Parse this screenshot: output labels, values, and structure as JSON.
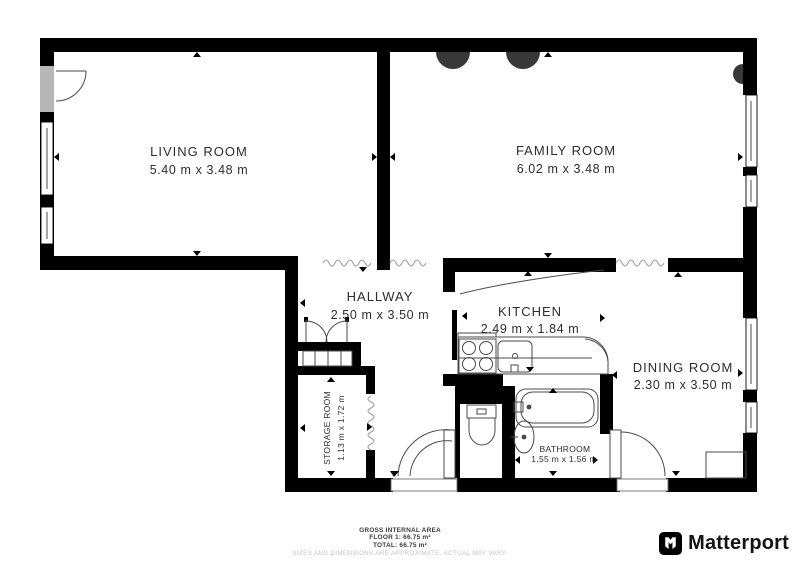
{
  "rooms": [
    {
      "id": "living-room",
      "name": "LIVING ROOM",
      "dims": "5.40 m x 3.48 m"
    },
    {
      "id": "family-room",
      "name": "FAMILY ROOM",
      "dims": "6.02 m x 3.48 m"
    },
    {
      "id": "hallway",
      "name": "HALLWAY",
      "dims": "2.50 m x 3.50 m"
    },
    {
      "id": "kitchen",
      "name": "KITCHEN",
      "dims": "2.49 m x 1.84 m"
    },
    {
      "id": "dining-room",
      "name": "DINING ROOM",
      "dims": "2.30 m x 3.50 m"
    },
    {
      "id": "storage-room",
      "name": "STORAGE ROOM",
      "dims": "1.13 m x 1.72 m"
    },
    {
      "id": "bathroom",
      "name": "BATHROOM",
      "dims": "1.55 m x 1.56 m"
    }
  ],
  "footer": {
    "line1": "GROSS INTERNAL AREA",
    "line2": "FLOOR 1: 66.75 m²",
    "line3": "TOTAL: 66.75 m²",
    "disclaimer": "SIZES AND DIMENSIONS ARE APPROXIMATE, ACTUAL MAY VARY."
  },
  "branding": {
    "logo_text": "Matterport"
  },
  "colors": {
    "wall": "#000000",
    "fixture_stroke": "#4a4a4a",
    "opening_marker": "#9a9a9a",
    "label": "#2d2d2d",
    "disclaimer": "#c3c3c3",
    "dark_object": "#383838"
  }
}
